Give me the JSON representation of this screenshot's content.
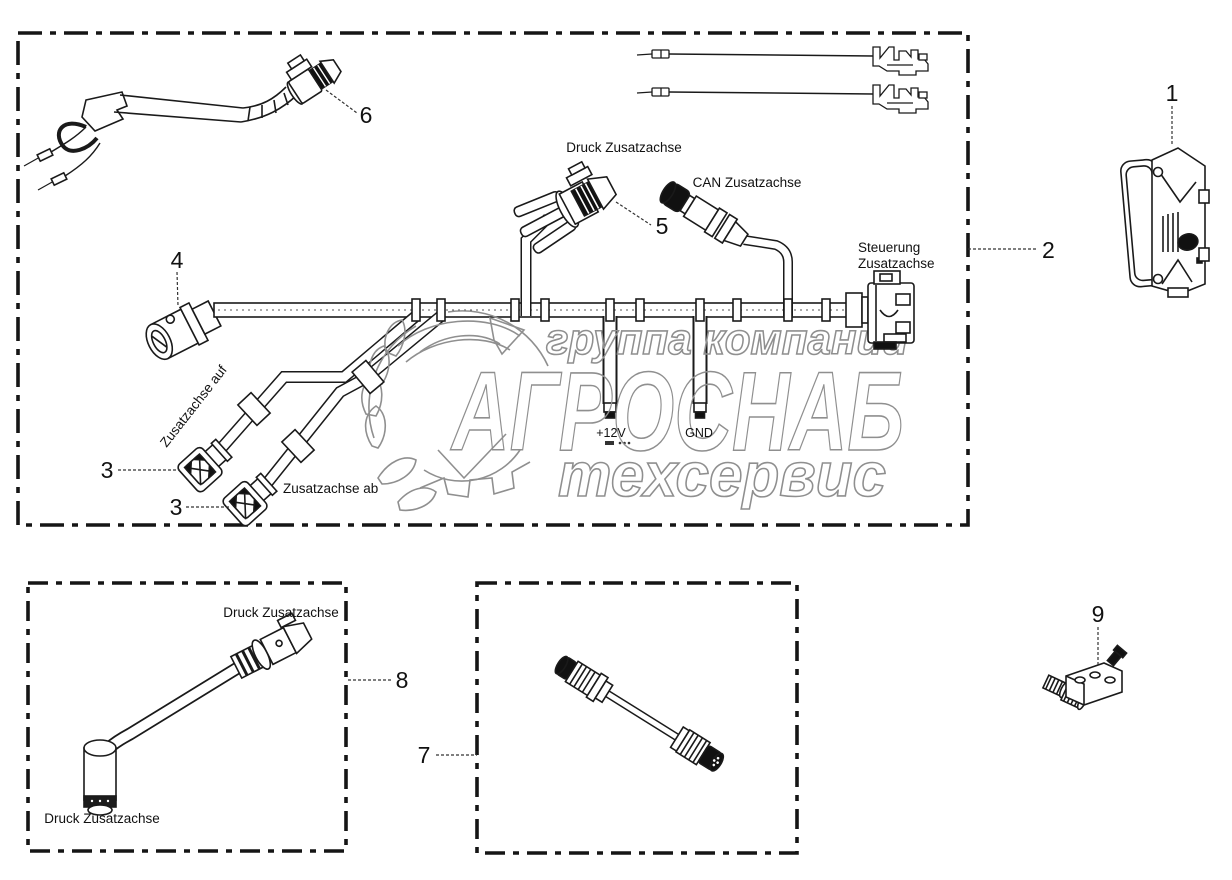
{
  "diagram": {
    "background": "#ffffff",
    "line_color": "#1a1a1a",
    "watermark": {
      "line1": "группа компаний",
      "line2": "АГРОСНАБ",
      "line3": "техсервис",
      "color": "#8f8f8f"
    },
    "callouts": {
      "part1": "1",
      "part2": "2",
      "part3a": "3",
      "part3b": "3",
      "part4": "4",
      "part5": "5",
      "part6": "6",
      "part7": "7",
      "part8": "8",
      "part9": "9"
    },
    "labels": {
      "druck_main": "Druck Zusatzachse",
      "can": "CAN Zusatzachse",
      "steuerung_line1": "Steuerung",
      "steuerung_line2": "Zusatzachse",
      "auf": "Zusatzachse auf",
      "ab": "Zusatzachse ab",
      "v12": "+12V",
      "gnd": "GND",
      "druck8_top": "Druck Zusatzachse",
      "druck8_bottom": "Druck Zusatzachse"
    }
  }
}
